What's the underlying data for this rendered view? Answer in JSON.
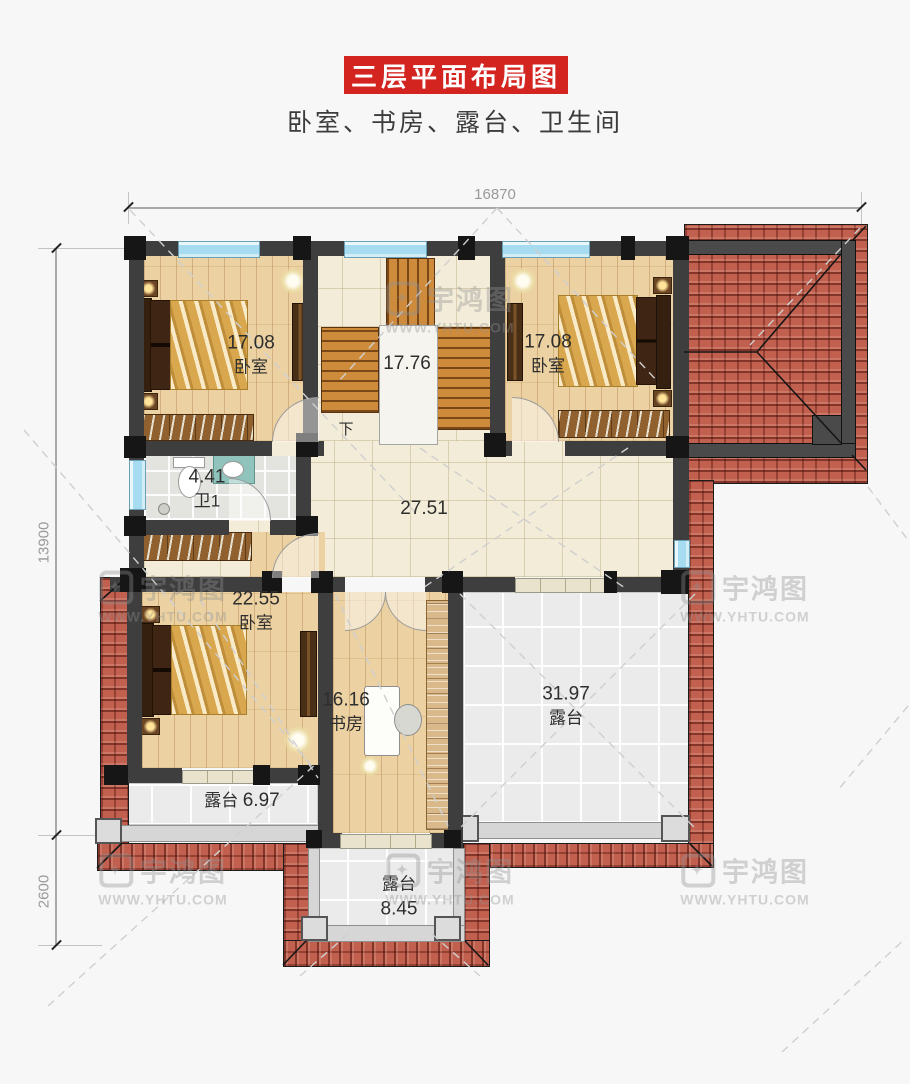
{
  "header": {
    "title": "三层平面布局图",
    "subtitle": "卧室、书房、露台、卫生间",
    "banner_color": "#d42420"
  },
  "dimensions": {
    "top_width": "16870",
    "left_height": "13900",
    "left_bottom": "2600"
  },
  "plan": {
    "rooms": {
      "bedroom_top_left": {
        "area": "17.08",
        "name": "卧室"
      },
      "stairwell": {
        "area": "17.76"
      },
      "bedroom_top_right": {
        "area": "17.08",
        "name": "卧室"
      },
      "bathroom": {
        "area": "4.41",
        "name": "卫1"
      },
      "hall": {
        "area": "27.51"
      },
      "bedroom_lower_left": {
        "area": "22.55",
        "name": "卧室"
      },
      "study": {
        "area": "16.16",
        "name": "书房"
      },
      "terrace_large": {
        "area": "31.97",
        "name": "露台"
      },
      "terrace_small": {
        "area": "6.97",
        "name": "露台"
      },
      "terrace_bottom": {
        "area": "8.45",
        "name": "露台"
      }
    },
    "stairs_down_label": "下"
  },
  "watermark": {
    "brand": "宇鸿图",
    "url": "WWW.YHTU.COM",
    "logo_glyph": "✦"
  },
  "colors": {
    "banner_red": "#d42420",
    "roof_tile": "#c2604f",
    "wall_gray": "#3e3e3e",
    "column_black": "#161616",
    "window_blue": "#a7dbef",
    "wood_floor": "#ecd2a2",
    "hall_floor": "#f2ecd8",
    "terrace_floor": "#ebebeb",
    "stair_tread": "#cf8b3c",
    "dim_gray": "#999999"
  }
}
